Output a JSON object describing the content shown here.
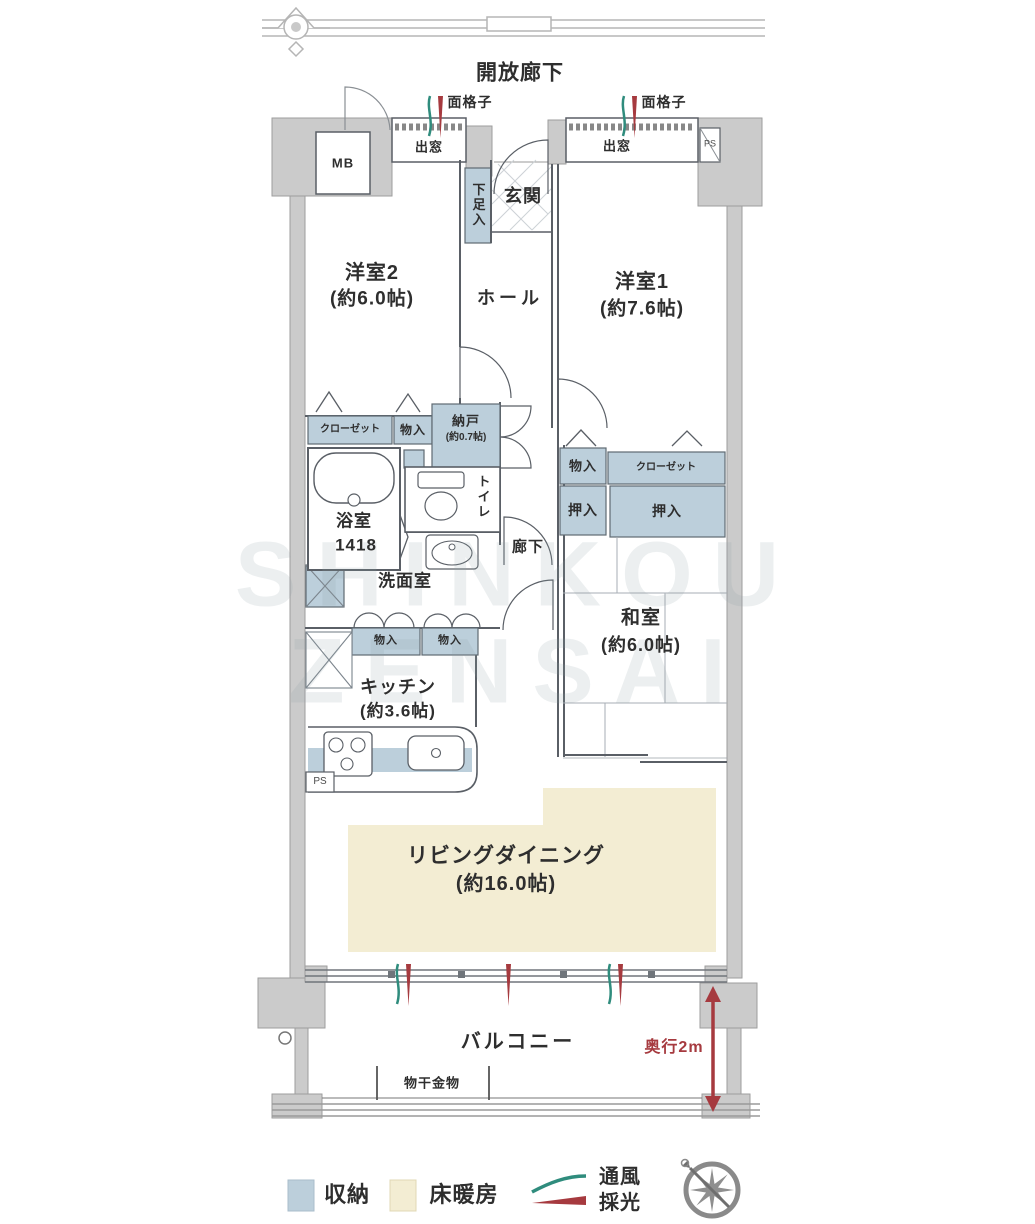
{
  "colors": {
    "wall_fill": "#cbcbcb",
    "storage_fill": "#bccfdb",
    "floor_heating_fill": "#f3edd3",
    "accent_red": "#a63a3f",
    "vent_green": "#2f8c7d",
    "line": "#5a5f66"
  },
  "plan": {
    "corridor_top": "開放廊下",
    "mb": "MB",
    "ps_top": "PS",
    "ps_kitchen": "PS",
    "lattice_left": "面格子",
    "lattice_right": "面格子",
    "baywindow_left": "出窓",
    "baywindow_right": "出窓",
    "entrance": "玄関",
    "shoe_box": "下足入",
    "hall": "ホール",
    "corridor": "廊下"
  },
  "rooms": {
    "western1": {
      "name": "洋室1",
      "size": "(約7.6帖)"
    },
    "western2": {
      "name": "洋室2",
      "size": "(約6.0帖)"
    },
    "japanese": {
      "name": "和室",
      "size": "(約6.0帖)"
    },
    "kitchen": {
      "name": "キッチン",
      "size": "(約3.6帖)"
    },
    "living": {
      "name": "リビングダイニング",
      "size": "(約16.0帖)"
    },
    "storeroom": {
      "name": "納戸",
      "size": "(約0.7帖)"
    },
    "bathroom": {
      "name": "浴室",
      "size": "1418"
    },
    "washroom": "洗面室",
    "toilet": "トイレ"
  },
  "storage": {
    "closet_w2": "クローゼット",
    "mono_w2": "物入",
    "mono_j": "物入",
    "closet_j": "クローゼット",
    "oshiire_left": "押入",
    "oshiire_right": "押入",
    "mono_k1": "物入",
    "mono_k2": "物入"
  },
  "balcony": {
    "label": "バルコニー",
    "laundry_hardware": "物干金物",
    "depth": "奥行2m"
  },
  "legend": {
    "storage": "収納",
    "floor_heating": "床暖房",
    "vent_line1": "通風",
    "vent_line2": "採光"
  },
  "watermark": {
    "line1": "SHINKOU",
    "line2": "ZENSAI"
  }
}
